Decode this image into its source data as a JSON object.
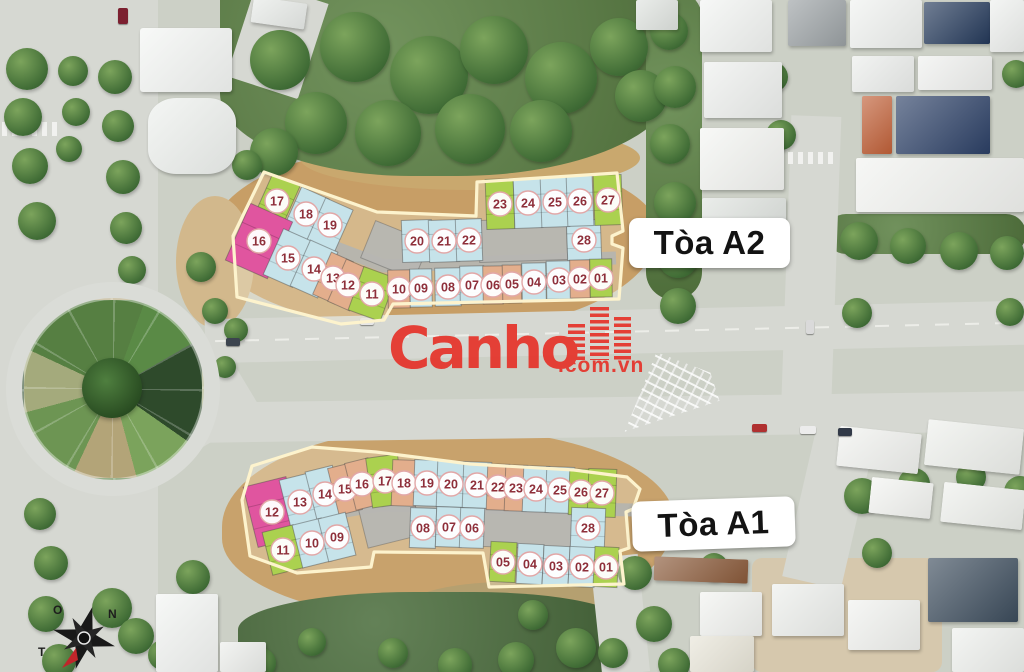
{
  "watermark": {
    "brand": "Canho",
    "suffix": ".com.vn",
    "color": "#e5372e",
    "icon": "buildings-icon"
  },
  "compass": {
    "letters": [
      {
        "t": "O",
        "x": 17,
        "y": 26
      },
      {
        "t": "N",
        "x": 72,
        "y": 30
      },
      {
        "t": "T",
        "x": 2,
        "y": 68
      }
    ]
  },
  "palette": {
    "green": "#abd14f",
    "blue": "#c6e3ea",
    "orange": "#e3ae8c",
    "pink": "#e0559f",
    "corridor": "#b4b4b0",
    "outline": "#fdf3cd",
    "circle_fill": "#ffffff",
    "circle_ring": "#e2a7a7",
    "number": "#8e2f3a"
  },
  "towers": [
    {
      "id": "A2",
      "label": "Tòa A2",
      "label_box": {
        "x": 629,
        "y": 218,
        "w": 161,
        "h": 50,
        "rot": 0
      },
      "outline": [
        [
          264,
          172
        ],
        [
          377,
          212
        ],
        [
          476,
          216
        ],
        [
          477,
          182
        ],
        [
          617,
          173
        ],
        [
          623,
          231
        ],
        [
          612,
          236
        ],
        [
          612,
          244
        ],
        [
          623,
          248
        ],
        [
          619,
          299
        ],
        [
          393,
          304
        ],
        [
          384,
          320
        ],
        [
          341,
          324
        ],
        [
          237,
          297
        ],
        [
          233,
          236
        ]
      ],
      "corridors": [
        {
          "pts": [
            [
              270,
              223
            ],
            [
              384,
              266
            ],
            [
              616,
              258
            ]
          ],
          "w": 13
        }
      ],
      "cores": [
        {
          "x": 523,
          "y": 240,
          "w": 88,
          "h": 42,
          "r": -2
        },
        {
          "x": 395,
          "y": 250,
          "w": 58,
          "h": 40,
          "r": 22
        }
      ],
      "units": [
        {
          "n": "17",
          "c": "green",
          "x": 277,
          "y": 201,
          "w": 30,
          "h": 46,
          "r": 24
        },
        {
          "n": "18",
          "c": "blue",
          "x": 306,
          "y": 214,
          "w": 30,
          "h": 46,
          "r": 24
        },
        {
          "n": "19",
          "c": "blue",
          "x": 330,
          "y": 225,
          "w": 30,
          "h": 46,
          "r": 24
        },
        {
          "n": "16",
          "c": "pink",
          "x": 259,
          "y": 241,
          "w": 46,
          "h": 62,
          "r": 24
        },
        {
          "n": "15",
          "c": "blue",
          "x": 288,
          "y": 258,
          "w": 32,
          "h": 50,
          "r": 24
        },
        {
          "n": "14",
          "c": "blue",
          "x": 314,
          "y": 269,
          "w": 30,
          "h": 50,
          "r": 24
        },
        {
          "n": "13",
          "c": "orange",
          "x": 333,
          "y": 278,
          "w": 24,
          "h": 46,
          "r": 24
        },
        {
          "n": "12",
          "c": "orange",
          "x": 348,
          "y": 285,
          "w": 24,
          "h": 46,
          "r": 24
        },
        {
          "n": "11",
          "c": "green",
          "x": 372,
          "y": 294,
          "w": 34,
          "h": 46,
          "r": 20
        },
        {
          "n": "20",
          "c": "blue",
          "x": 417,
          "y": 241,
          "w": 30,
          "h": 42,
          "r": -2
        },
        {
          "n": "21",
          "c": "blue",
          "x": 444,
          "y": 241,
          "w": 30,
          "h": 42,
          "r": -2
        },
        {
          "n": "22",
          "c": "blue",
          "x": 469,
          "y": 240,
          "w": 26,
          "h": 42,
          "r": -2
        },
        {
          "n": "28",
          "c": "blue",
          "x": 584,
          "y": 240,
          "w": 34,
          "h": 40,
          "r": -2
        },
        {
          "n": "23",
          "c": "green",
          "x": 500,
          "y": 204,
          "w": 28,
          "h": 50,
          "r": -2
        },
        {
          "n": "24",
          "c": "blue",
          "x": 528,
          "y": 203,
          "w": 28,
          "h": 50,
          "r": -2
        },
        {
          "n": "25",
          "c": "blue",
          "x": 555,
          "y": 202,
          "w": 28,
          "h": 50,
          "r": -2
        },
        {
          "n": "26",
          "c": "blue",
          "x": 580,
          "y": 201,
          "w": 26,
          "h": 50,
          "r": -2
        },
        {
          "n": "27",
          "c": "green",
          "x": 608,
          "y": 200,
          "w": 28,
          "h": 50,
          "r": -2
        },
        {
          "n": "10",
          "c": "orange",
          "x": 399,
          "y": 289,
          "w": 22,
          "h": 38,
          "r": -1
        },
        {
          "n": "09",
          "c": "blue",
          "x": 421,
          "y": 288,
          "w": 22,
          "h": 38,
          "r": -1
        },
        {
          "n": "08",
          "c": "blue",
          "x": 448,
          "y": 287,
          "w": 26,
          "h": 38,
          "r": -1
        },
        {
          "n": "07",
          "c": "blue",
          "x": 472,
          "y": 285,
          "w": 24,
          "h": 38,
          "r": -1
        },
        {
          "n": "06",
          "c": "orange",
          "x": 493,
          "y": 285,
          "w": 20,
          "h": 38,
          "r": -1
        },
        {
          "n": "05",
          "c": "orange",
          "x": 512,
          "y": 284,
          "w": 19,
          "h": 38,
          "r": -1
        },
        {
          "n": "04",
          "c": "blue",
          "x": 534,
          "y": 282,
          "w": 24,
          "h": 38,
          "r": -1
        },
        {
          "n": "03",
          "c": "blue",
          "x": 559,
          "y": 280,
          "w": 25,
          "h": 38,
          "r": -1
        },
        {
          "n": "02",
          "c": "orange",
          "x": 580,
          "y": 279,
          "w": 20,
          "h": 38,
          "r": -1
        },
        {
          "n": "01",
          "c": "green",
          "x": 601,
          "y": 278,
          "w": 22,
          "h": 38,
          "r": -1
        }
      ]
    },
    {
      "id": "A1",
      "label": "Tòa A1",
      "label_box": {
        "x": 632,
        "y": 499,
        "w": 163,
        "h": 50,
        "rot": -2
      },
      "outline": [
        [
          252,
          466
        ],
        [
          312,
          447
        ],
        [
          376,
          452
        ],
        [
          470,
          464
        ],
        [
          574,
          470
        ],
        [
          627,
          477
        ],
        [
          640,
          489
        ],
        [
          633,
          509
        ],
        [
          626,
          512
        ],
        [
          629,
          548
        ],
        [
          620,
          551
        ],
        [
          624,
          584
        ],
        [
          489,
          587
        ],
        [
          483,
          553
        ],
        [
          374,
          552
        ],
        [
          371,
          567
        ],
        [
          297,
          573
        ],
        [
          250,
          556
        ],
        [
          242,
          500
        ]
      ],
      "corridors": [
        {
          "pts": [
            [
              265,
              525
            ],
            [
              380,
              505
            ],
            [
              633,
              510
            ]
          ],
          "w": 13
        }
      ],
      "cores": [
        {
          "x": 528,
          "y": 528,
          "w": 96,
          "h": 40,
          "r": 2
        },
        {
          "x": 390,
          "y": 520,
          "w": 56,
          "h": 44,
          "r": -14
        }
      ],
      "units": [
        {
          "n": "12",
          "c": "pink",
          "x": 272,
          "y": 512,
          "w": 44,
          "h": 62,
          "r": -14
        },
        {
          "n": "13",
          "c": "blue",
          "x": 300,
          "y": 502,
          "w": 30,
          "h": 52,
          "r": -14
        },
        {
          "n": "14",
          "c": "blue",
          "x": 325,
          "y": 494,
          "w": 28,
          "h": 52,
          "r": -14
        },
        {
          "n": "15",
          "c": "orange",
          "x": 345,
          "y": 489,
          "w": 24,
          "h": 48,
          "r": -14
        },
        {
          "n": "16",
          "c": "orange",
          "x": 362,
          "y": 484,
          "w": 24,
          "h": 48,
          "r": -14
        },
        {
          "n": "17",
          "c": "green",
          "x": 385,
          "y": 481,
          "w": 32,
          "h": 50,
          "r": -8
        },
        {
          "n": "11",
          "c": "green",
          "x": 283,
          "y": 550,
          "w": 32,
          "h": 44,
          "r": -14
        },
        {
          "n": "10",
          "c": "blue",
          "x": 312,
          "y": 543,
          "w": 30,
          "h": 44,
          "r": -14
        },
        {
          "n": "09",
          "c": "blue",
          "x": 337,
          "y": 537,
          "w": 28,
          "h": 44,
          "r": -14
        },
        {
          "n": "18",
          "c": "orange",
          "x": 404,
          "y": 483,
          "w": 24,
          "h": 46,
          "r": 2
        },
        {
          "n": "19",
          "c": "blue",
          "x": 427,
          "y": 483,
          "w": 26,
          "h": 46,
          "r": 2
        },
        {
          "n": "20",
          "c": "blue",
          "x": 451,
          "y": 484,
          "w": 28,
          "h": 46,
          "r": 2
        },
        {
          "n": "21",
          "c": "blue",
          "x": 477,
          "y": 485,
          "w": 28,
          "h": 46,
          "r": 2
        },
        {
          "n": "22",
          "c": "orange",
          "x": 498,
          "y": 487,
          "w": 22,
          "h": 46,
          "r": 2
        },
        {
          "n": "23",
          "c": "orange",
          "x": 516,
          "y": 488,
          "w": 22,
          "h": 46,
          "r": 2
        },
        {
          "n": "24",
          "c": "blue",
          "x": 536,
          "y": 489,
          "w": 26,
          "h": 46,
          "r": 2
        },
        {
          "n": "25",
          "c": "blue",
          "x": 560,
          "y": 490,
          "w": 28,
          "h": 46,
          "r": 2
        },
        {
          "n": "26",
          "c": "green",
          "x": 581,
          "y": 492,
          "w": 24,
          "h": 46,
          "r": 2
        },
        {
          "n": "27",
          "c": "green",
          "x": 602,
          "y": 493,
          "w": 28,
          "h": 48,
          "r": 2
        },
        {
          "n": "08",
          "c": "blue",
          "x": 423,
          "y": 528,
          "w": 26,
          "h": 40,
          "r": 2
        },
        {
          "n": "07",
          "c": "blue",
          "x": 449,
          "y": 527,
          "w": 26,
          "h": 40,
          "r": 2
        },
        {
          "n": "06",
          "c": "blue",
          "x": 472,
          "y": 528,
          "w": 24,
          "h": 40,
          "r": 2
        },
        {
          "n": "28",
          "c": "blue",
          "x": 588,
          "y": 528,
          "w": 34,
          "h": 40,
          "r": 2
        },
        {
          "n": "05",
          "c": "green",
          "x": 503,
          "y": 562,
          "w": 26,
          "h": 40,
          "r": 3
        },
        {
          "n": "04",
          "c": "blue",
          "x": 530,
          "y": 564,
          "w": 26,
          "h": 40,
          "r": 3
        },
        {
          "n": "03",
          "c": "blue",
          "x": 556,
          "y": 566,
          "w": 26,
          "h": 40,
          "r": 3
        },
        {
          "n": "02",
          "c": "blue",
          "x": 582,
          "y": 567,
          "w": 26,
          "h": 40,
          "r": 3
        },
        {
          "n": "01",
          "c": "green",
          "x": 606,
          "y": 567,
          "w": 24,
          "h": 40,
          "r": 3
        }
      ]
    }
  ]
}
